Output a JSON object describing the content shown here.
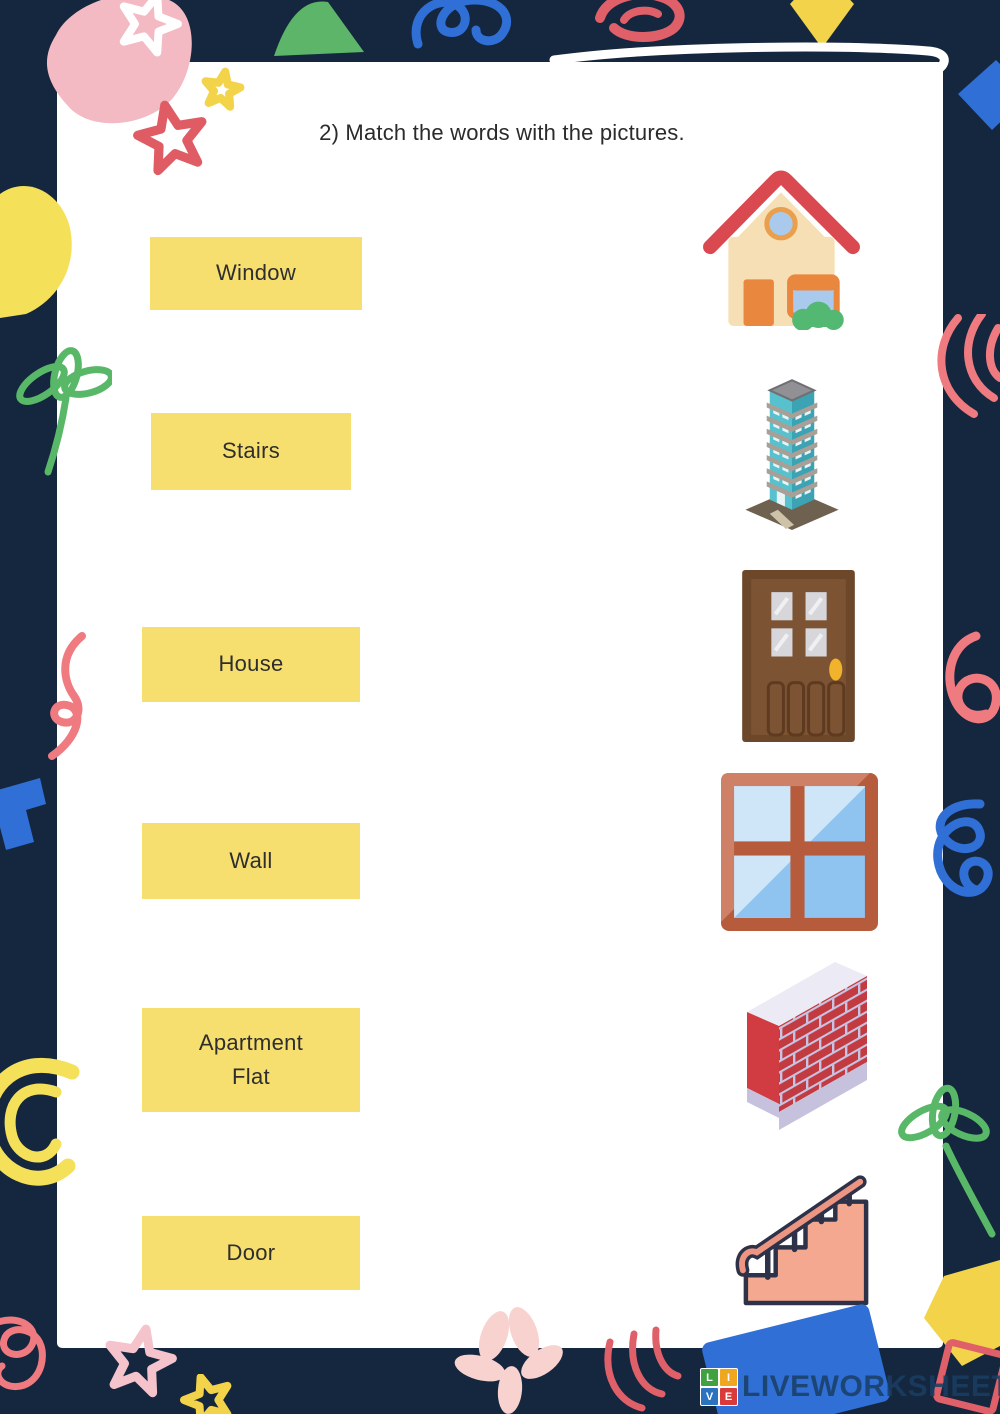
{
  "worksheet": {
    "title": "2) Match the words with the pictures."
  },
  "words": [
    {
      "id": "window",
      "label": "Window"
    },
    {
      "id": "stairs",
      "label": "Stairs"
    },
    {
      "id": "house",
      "label": "House"
    },
    {
      "id": "wall",
      "label": "Wall"
    },
    {
      "id": "apartment",
      "label": "Apartment\nFlat"
    },
    {
      "id": "door",
      "label": "Door"
    }
  ],
  "pictures": [
    {
      "id": "house",
      "name": "house"
    },
    {
      "id": "apartment-building",
      "name": "apartment building"
    },
    {
      "id": "door",
      "name": "door"
    },
    {
      "id": "window",
      "name": "window"
    },
    {
      "id": "brick-wall",
      "name": "brick wall"
    },
    {
      "id": "stairs",
      "name": "stairs"
    }
  ],
  "watermark": {
    "logo_letters": [
      "L",
      "I",
      "V",
      "E"
    ],
    "brand": "LIVEWORKSHEETS"
  },
  "colors": {
    "background": "#14273E",
    "page": "#FFFFFF",
    "word_box": "#F6DE6F",
    "accent_red": "#E0606A",
    "accent_pink": "#F3BAC3",
    "accent_yellow": "#F2D349",
    "accent_green": "#5CB568",
    "accent_blue": "#2F6FD6"
  }
}
